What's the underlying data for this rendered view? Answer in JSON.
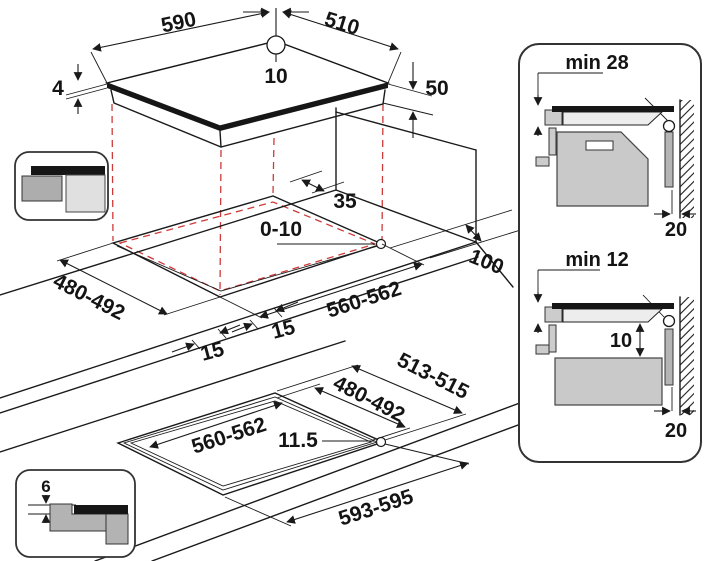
{
  "labels": {
    "top": {
      "width": "590",
      "depth": "510",
      "rear_offset": "10",
      "glass_thickness": "4",
      "body_height": "50"
    },
    "mid": {
      "rear_clearance": "35",
      "corner_radius": "0-10",
      "side_clearance": "100",
      "depth": "480-492",
      "width": "560-562",
      "margin_front": "15",
      "margin_left": "15"
    },
    "bottom": {
      "outer_depth": "513-515",
      "depth": "480-492",
      "width": "560-562",
      "corner_radius": "11.5",
      "outer_width": "593-595",
      "recess_depth": "6"
    },
    "panel_top": {
      "min_front": "min 28",
      "cable_distance": "247.5",
      "wall_gap": "20"
    },
    "panel_bottom": {
      "min_front": "min 12",
      "cable_distance": "247.5",
      "below_gap": "10",
      "wall_gap": "20"
    }
  },
  "colors": {
    "line": "#1a1a1a",
    "projection_red": "#cf3a3a",
    "glass_black": "#161616",
    "gray_light": "#ededed",
    "gray_mid": "#c9c9c9",
    "gray_dark": "#adadad",
    "background": "#ffffff"
  }
}
